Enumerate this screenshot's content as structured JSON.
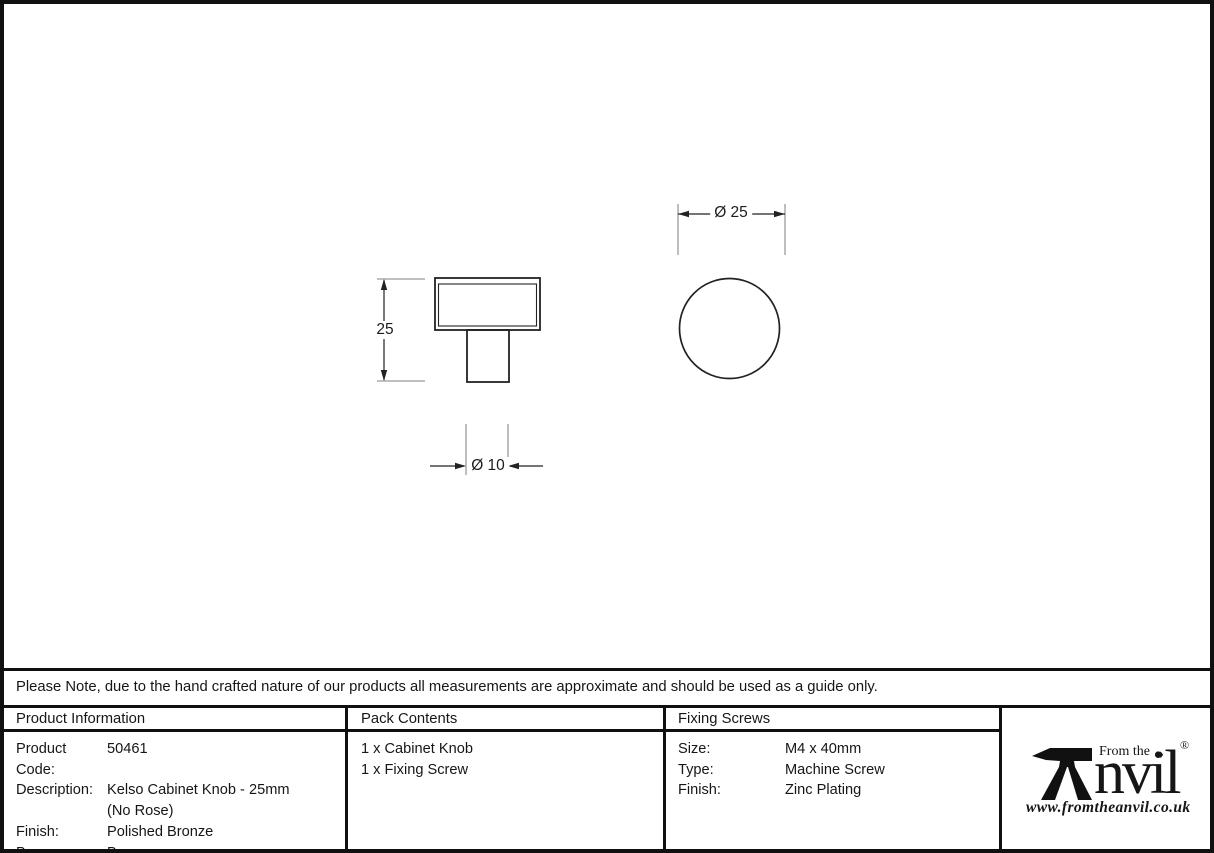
{
  "note": "Please Note, due to the hand crafted nature of our products all measurements are approximate and should be used as a guide only.",
  "drawing": {
    "side_view_height_label": "25",
    "stem_diameter_label": "Ø 10",
    "knob_diameter_label": "Ø 25"
  },
  "table": {
    "product_information": {
      "header": "Product Information",
      "rows": [
        {
          "label": "Product Code:",
          "value": "50461"
        },
        {
          "label": "Description:",
          "value": "Kelso Cabinet Knob - 25mm"
        },
        {
          "label": "",
          "value": "(No Rose)"
        },
        {
          "label": "Finish:",
          "value": "Polished Bronze"
        },
        {
          "label": "Base Material:",
          "value": "Bronze"
        }
      ]
    },
    "pack_contents": {
      "header": "Pack Contents",
      "items": [
        "1 x Cabinet Knob",
        "1 x Fixing Screw"
      ]
    },
    "fixing_screws": {
      "header": "Fixing Screws",
      "rows": [
        {
          "label": "Size:",
          "value": "M4 x 40mm"
        },
        {
          "label": "Type:",
          "value": "Machine Screw"
        },
        {
          "label": "Finish:",
          "value": "Zinc Plating"
        }
      ]
    }
  },
  "logo": {
    "from_the": "From the",
    "diamond": "♦",
    "brand_rest": "nvil",
    "registered": "®",
    "website": "www.fromtheanvil.co.uk"
  },
  "colors": {
    "line_dark": "#222222",
    "line_gray": "#9a9a9a",
    "border_black": "#101010",
    "background": "#ffffff"
  }
}
